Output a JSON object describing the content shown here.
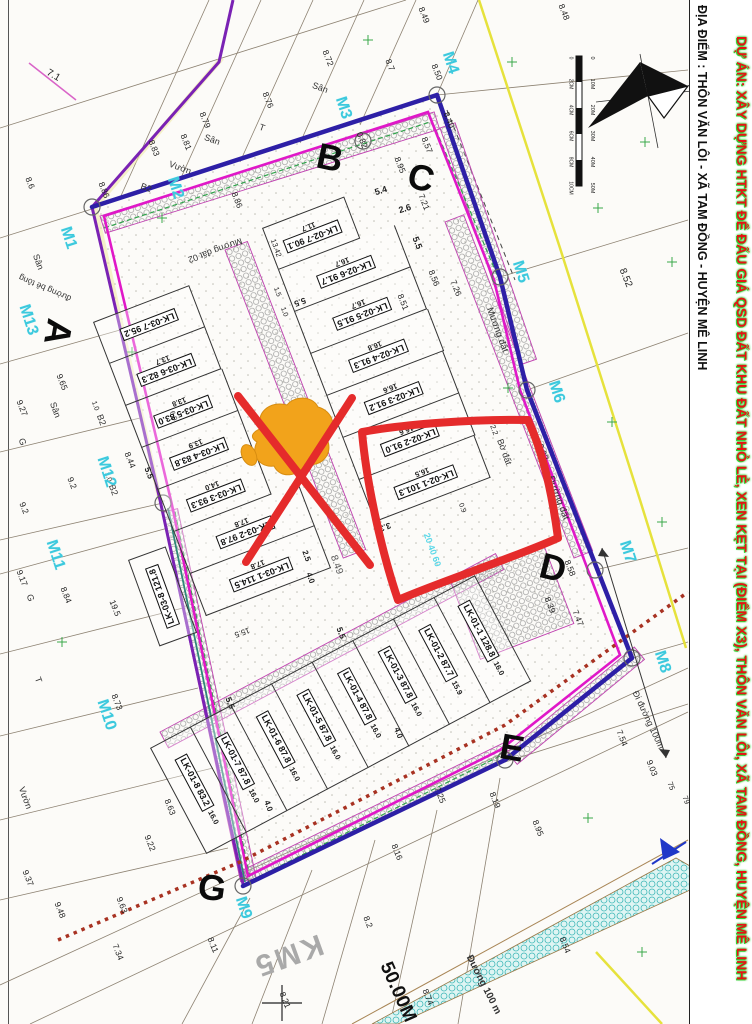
{
  "margin": {
    "project_title": "DỰ ÁN: XÂY DỰNG HTKT ĐỂ ĐẤU GIÁ QSD ĐẤT KHU ĐẤT NHỎ LẺ, XEN KẸT TẠI (ĐIỂM X3), THÔN VĂN LÔI, XÃ TAM ĐỒNG, HUYỆN MÊ LINH",
    "location": "ĐỊA ĐIỂM : THÔN VĂN LÔI - XÃ TAM ĐỒNG - HUYỆN MÊ LINH"
  },
  "compass": {
    "north_label": "B"
  },
  "scale_bar": {
    "m_labels": [
      "0",
      "10M",
      "20M",
      "30M",
      "40M",
      "50M"
    ],
    "cm_labels": [
      "0",
      "2CM",
      "4CM",
      "6CM",
      "8CM",
      "10CM"
    ]
  },
  "colors": {
    "boundary_indigo": "#2d1fa6",
    "inner_magenta": "#e018c8",
    "road_violet": "#7a22b4",
    "annotation_red": "#e52b2b",
    "marker_orange": "#f2a31b",
    "vertex_cyan": "#3cc9dd",
    "dotted_red": "#a83222",
    "teal_road": "#3fb8b8",
    "yellow_line": "#e6e23c"
  },
  "blocks": [
    {
      "id": "lk02",
      "plots": [
        {
          "n": "LK-02-7",
          "a": "90.1",
          "d": "11.7"
        },
        {
          "n": "LK-02-6",
          "a": "91.7",
          "d": "16.7"
        },
        {
          "n": "LK-02-5",
          "a": "91.5",
          "d": "16.7"
        },
        {
          "n": "LK-02-4",
          "a": "91.3",
          "d": "16.8"
        },
        {
          "n": "LK-02-3",
          "a": "91.2",
          "d": "16.6"
        },
        {
          "n": "LK-02-2",
          "a": "91.0",
          "d": "16.6"
        },
        {
          "n": "LK-02-1",
          "a": "101.3",
          "d": "16.5"
        }
      ]
    },
    {
      "id": "lk03",
      "plots": [
        {
          "n": "LK-03-7",
          "a": "95.2",
          "d": ""
        },
        {
          "n": "LK-03-6",
          "a": "82.3",
          "d": "13.7"
        },
        {
          "n": "LK-03-5",
          "a": "83.0",
          "d": "13.8"
        },
        {
          "n": "LK-03-4",
          "a": "83.8",
          "d": "13.9"
        },
        {
          "n": "LK-03-3",
          "a": "93.3",
          "d": "14.0"
        },
        {
          "n": "LK-03-2",
          "a": "97.8",
          "d": "17.8"
        },
        {
          "n": "LK-03-1",
          "a": "114.5",
          "d": "17.8"
        }
      ]
    },
    {
      "id": "lk01",
      "plots": [
        {
          "n": "LK-01-8",
          "a": "83.2",
          "d": "16.0"
        },
        {
          "n": "LK-01-7",
          "a": "87.8",
          "d": "16.0"
        },
        {
          "n": "LK-01-6",
          "a": "87.8",
          "d": "16.0"
        },
        {
          "n": "LK-01-5",
          "a": "87.8",
          "d": "16.0"
        },
        {
          "n": "LK-01-4",
          "a": "87.8",
          "d": "16.0"
        },
        {
          "n": "LK-01-3",
          "a": "87.8",
          "d": "16.0"
        },
        {
          "n": "LK-01-2",
          "a": "87.7",
          "d": "15.9"
        },
        {
          "n": "LK-01-1",
          "a": "128.8",
          "d": "16.0"
        }
      ]
    },
    {
      "id": "lk038",
      "plots": [
        {
          "n": "LK-03-8",
          "a": "121.8",
          "d": ""
        }
      ]
    }
  ],
  "corner_letters": [
    {
      "t": "A",
      "x": 58,
      "y": 332,
      "r": 100
    },
    {
      "t": "B",
      "x": 330,
      "y": 158,
      "r": 12
    },
    {
      "t": "C",
      "x": 421,
      "y": 178,
      "r": 14
    },
    {
      "t": "D",
      "x": 553,
      "y": 568,
      "r": 14
    },
    {
      "t": "E",
      "x": 512,
      "y": 748,
      "r": 10
    },
    {
      "t": "G",
      "x": 212,
      "y": 888,
      "r": 8
    }
  ],
  "boundary_markers": [
    {
      "t": "M1",
      "x": 68,
      "y": 238,
      "r": 72
    },
    {
      "t": "M2",
      "x": 175,
      "y": 188,
      "r": 72
    },
    {
      "t": "M3",
      "x": 343,
      "y": 108,
      "r": 72
    },
    {
      "t": "M4",
      "x": 450,
      "y": 63,
      "r": 72
    },
    {
      "t": "M5",
      "x": 520,
      "y": 272,
      "r": 72
    },
    {
      "t": "M6",
      "x": 556,
      "y": 392,
      "r": 72
    },
    {
      "t": "M7",
      "x": 627,
      "y": 552,
      "r": 72
    },
    {
      "t": "M8",
      "x": 662,
      "y": 662,
      "r": 72
    },
    {
      "t": "M9",
      "x": 243,
      "y": 908,
      "r": 72
    },
    {
      "t": "M10",
      "x": 106,
      "y": 715,
      "r": 72
    },
    {
      "t": "M11",
      "x": 55,
      "y": 555,
      "r": 72
    },
    {
      "t": "M12",
      "x": 106,
      "y": 472,
      "r": 72
    },
    {
      "t": "M13",
      "x": 28,
      "y": 320,
      "r": 72
    }
  ],
  "numbers": [
    {
      "t": "7.1",
      "x": 53,
      "y": 76,
      "r": 30,
      "s": 10
    },
    {
      "t": "8.72",
      "x": 328,
      "y": 58,
      "r": 68
    },
    {
      "t": "8.7",
      "x": 390,
      "y": 65,
      "r": 68
    },
    {
      "t": "8.76",
      "x": 268,
      "y": 100,
      "r": 68
    },
    {
      "t": "8.79",
      "x": 205,
      "y": 120,
      "r": 68
    },
    {
      "t": "8.81",
      "x": 186,
      "y": 142,
      "r": 68
    },
    {
      "t": "8.83",
      "x": 154,
      "y": 148,
      "r": 68
    },
    {
      "t": "8.86",
      "x": 104,
      "y": 190,
      "r": 68
    },
    {
      "t": "8.86",
      "x": 237,
      "y": 200,
      "r": 68
    },
    {
      "t": "8.6",
      "x": 30,
      "y": 183,
      "r": 68
    },
    {
      "t": "8.48",
      "x": 564,
      "y": 12,
      "r": 68
    },
    {
      "t": "8.49",
      "x": 424,
      "y": 15,
      "r": 68
    },
    {
      "t": "8.50",
      "x": 437,
      "y": 72,
      "r": 68
    },
    {
      "t": "8.40",
      "x": 449,
      "y": 120,
      "r": 68
    },
    {
      "t": "0.82",
      "x": 362,
      "y": 140,
      "r": 68
    },
    {
      "t": "8.57",
      "x": 427,
      "y": 145,
      "r": 68
    },
    {
      "t": "8.95",
      "x": 400,
      "y": 165,
      "r": 68
    },
    {
      "t": "7.21",
      "x": 424,
      "y": 202,
      "r": 68
    },
    {
      "t": "5.4",
      "x": 381,
      "y": 191,
      "r": -17,
      "b": 1,
      "s": 9
    },
    {
      "t": "2.6",
      "x": 405,
      "y": 209,
      "r": -17,
      "b": 1,
      "s": 9
    },
    {
      "t": "5.5",
      "x": 417,
      "y": 243,
      "r": 68,
      "b": 1,
      "s": 9
    },
    {
      "t": "8.56",
      "x": 434,
      "y": 278,
      "r": 68
    },
    {
      "t": "7.26",
      "x": 456,
      "y": 288,
      "r": 68
    },
    {
      "t": "8.51",
      "x": 403,
      "y": 302,
      "r": 68
    },
    {
      "t": "8.52",
      "x": 625,
      "y": 278,
      "r": 68,
      "s": 10
    },
    {
      "t": "9.02",
      "x": 543,
      "y": 452,
      "r": 68
    },
    {
      "t": "8.58",
      "x": 570,
      "y": 568,
      "r": 68
    },
    {
      "t": "8.39",
      "x": 550,
      "y": 605,
      "r": 68
    },
    {
      "t": "7.47",
      "x": 578,
      "y": 618,
      "r": 68
    },
    {
      "t": "7.54",
      "x": 622,
      "y": 738,
      "r": 68
    },
    {
      "t": "9.03",
      "x": 652,
      "y": 768,
      "r": 68
    },
    {
      "t": "75",
      "x": 671,
      "y": 786,
      "r": 68,
      "s": 7.5
    },
    {
      "t": "79",
      "x": 686,
      "y": 800,
      "r": 68,
      "s": 7.5
    },
    {
      "t": "9.65",
      "x": 62,
      "y": 382,
      "r": 68
    },
    {
      "t": "9.27",
      "x": 22,
      "y": 408,
      "r": 68
    },
    {
      "t": "9.2",
      "x": 72,
      "y": 483,
      "r": 68
    },
    {
      "t": "9.2",
      "x": 24,
      "y": 508,
      "r": 68
    },
    {
      "t": "9.17",
      "x": 22,
      "y": 578,
      "r": 68
    },
    {
      "t": "8.84",
      "x": 66,
      "y": 595,
      "r": 68
    },
    {
      "t": "19.5",
      "x": 115,
      "y": 608,
      "r": 68
    },
    {
      "t": "8.73",
      "x": 117,
      "y": 702,
      "r": 68
    },
    {
      "t": "8.44",
      "x": 130,
      "y": 460,
      "r": 68
    },
    {
      "t": "6.0",
      "x": 173,
      "y": 416,
      "r": 70,
      "s": 7
    },
    {
      "t": "9.37",
      "x": 28,
      "y": 878,
      "r": 68
    },
    {
      "t": "9.48",
      "x": 60,
      "y": 910,
      "r": 68
    },
    {
      "t": "7.34",
      "x": 118,
      "y": 952,
      "r": 68
    },
    {
      "t": "9.63",
      "x": 122,
      "y": 905,
      "r": 68
    },
    {
      "t": "9.22",
      "x": 150,
      "y": 843,
      "r": 68
    },
    {
      "t": "8.63",
      "x": 170,
      "y": 807,
      "r": 68
    },
    {
      "t": "8.11",
      "x": 213,
      "y": 945,
      "r": 68
    },
    {
      "t": "8.21",
      "x": 285,
      "y": 1000,
      "r": 68
    },
    {
      "t": "8.2",
      "x": 368,
      "y": 922,
      "r": 68
    },
    {
      "t": "8.16",
      "x": 397,
      "y": 852,
      "r": 68
    },
    {
      "t": "7.25",
      "x": 440,
      "y": 795,
      "r": 68
    },
    {
      "t": "8.19",
      "x": 495,
      "y": 800,
      "r": 68
    },
    {
      "t": "8.95",
      "x": 538,
      "y": 828,
      "r": 68
    },
    {
      "t": "8.74",
      "x": 428,
      "y": 997,
      "r": 68
    },
    {
      "t": "8.54",
      "x": 565,
      "y": 945,
      "r": 68
    },
    {
      "t": "8.49",
      "x": 336,
      "y": 565,
      "r": 70,
      "s": 10,
      "c": "#555"
    },
    {
      "t": "13.42",
      "x": 276,
      "y": 248,
      "r": 70,
      "s": 7.5
    },
    {
      "t": "1.5",
      "x": 277,
      "y": 292,
      "r": 70,
      "s": 7
    },
    {
      "t": "1.0",
      "x": 284,
      "y": 312,
      "r": 70,
      "s": 7
    },
    {
      "t": "5.5",
      "x": 300,
      "y": 302,
      "r": 160,
      "b": 1
    },
    {
      "t": "3.3",
      "x": 385,
      "y": 527,
      "r": 160,
      "b": 1
    },
    {
      "t": "0.9",
      "x": 462,
      "y": 508,
      "r": 70,
      "s": 7
    },
    {
      "t": "2.5",
      "x": 306,
      "y": 556,
      "r": 70,
      "b": 1,
      "s": 8
    },
    {
      "t": "4.0",
      "x": 310,
      "y": 578,
      "r": 70,
      "b": 1,
      "s": 8
    },
    {
      "t": "15.5",
      "x": 242,
      "y": 632,
      "r": 160,
      "s": 8
    },
    {
      "t": "5.5",
      "x": 230,
      "y": 703,
      "r": 70,
      "b": 1
    },
    {
      "t": "5.5",
      "x": 341,
      "y": 633,
      "r": 70,
      "b": 1
    },
    {
      "t": "4.0",
      "x": 268,
      "y": 806,
      "r": 70,
      "b": 1,
      "s": 8
    },
    {
      "t": "4.0",
      "x": 398,
      "y": 733,
      "r": 70,
      "b": 1,
      "s": 8
    },
    {
      "t": "2.2",
      "x": 494,
      "y": 430,
      "r": 70,
      "s": 7.5
    },
    {
      "t": "5.5",
      "x": 149,
      "y": 473,
      "r": 70,
      "b": 1
    },
    {
      "t": "1.0",
      "x": 95,
      "y": 406,
      "r": 70,
      "s": 7
    },
    {
      "t": "1.0",
      "x": 108,
      "y": 477,
      "r": 70,
      "s": 7
    }
  ],
  "texts": [
    {
      "t": "Sân",
      "x": 320,
      "y": 88,
      "r": 20
    },
    {
      "t": "Sân",
      "x": 212,
      "y": 140,
      "r": 20
    },
    {
      "t": "Sân",
      "x": 38,
      "y": 262,
      "r": 70
    },
    {
      "t": "Sân",
      "x": 55,
      "y": 410,
      "r": 70
    },
    {
      "t": "Vườn",
      "x": 180,
      "y": 168,
      "r": 20
    },
    {
      "t": "Vườn",
      "x": 25,
      "y": 798,
      "r": 70
    },
    {
      "t": "B2",
      "x": 146,
      "y": 188,
      "r": 20
    },
    {
      "t": "B2",
      "x": 101,
      "y": 420,
      "r": 70
    },
    {
      "t": "B2",
      "x": 113,
      "y": 490,
      "r": 70
    },
    {
      "t": "T",
      "x": 262,
      "y": 128,
      "r": 20
    },
    {
      "t": "T",
      "x": 38,
      "y": 680,
      "r": 70
    },
    {
      "t": "G",
      "x": 30,
      "y": 598,
      "r": 70
    },
    {
      "t": "G",
      "x": 22,
      "y": 442,
      "r": 70
    },
    {
      "t": "Mương đất 02",
      "x": 215,
      "y": 250,
      "r": 160
    },
    {
      "t": "Mương đất",
      "x": 497,
      "y": 330,
      "r": 70,
      "s": 9.5
    },
    {
      "t": "Bờ đất",
      "x": 504,
      "y": 452,
      "r": 70
    },
    {
      "t": "Đường đất",
      "x": 558,
      "y": 498,
      "r": 70,
      "s": 9.5
    },
    {
      "t": "đường bê tông",
      "x": 45,
      "y": 288,
      "r": 203,
      "s": 8.5
    },
    {
      "t": "Đi đường 100m",
      "x": 648,
      "y": 720,
      "r": 65
    },
    {
      "t": "Đường 100 m",
      "x": 483,
      "y": 985,
      "r": 63,
      "s": 10,
      "b": 1
    },
    {
      "t": "KM5",
      "x": 288,
      "y": 955,
      "r": 160,
      "s": 30,
      "c": "#a9a9a9",
      "b": 1,
      "ls": 3
    },
    {
      "t": "50.00M",
      "x": 398,
      "y": 992,
      "r": 66,
      "s": 19,
      "c": "#111",
      "b": 1
    },
    {
      "t": "20 40 60",
      "x": 432,
      "y": 550,
      "r": 70,
      "c": "#5ad8e8",
      "b": 1
    }
  ]
}
